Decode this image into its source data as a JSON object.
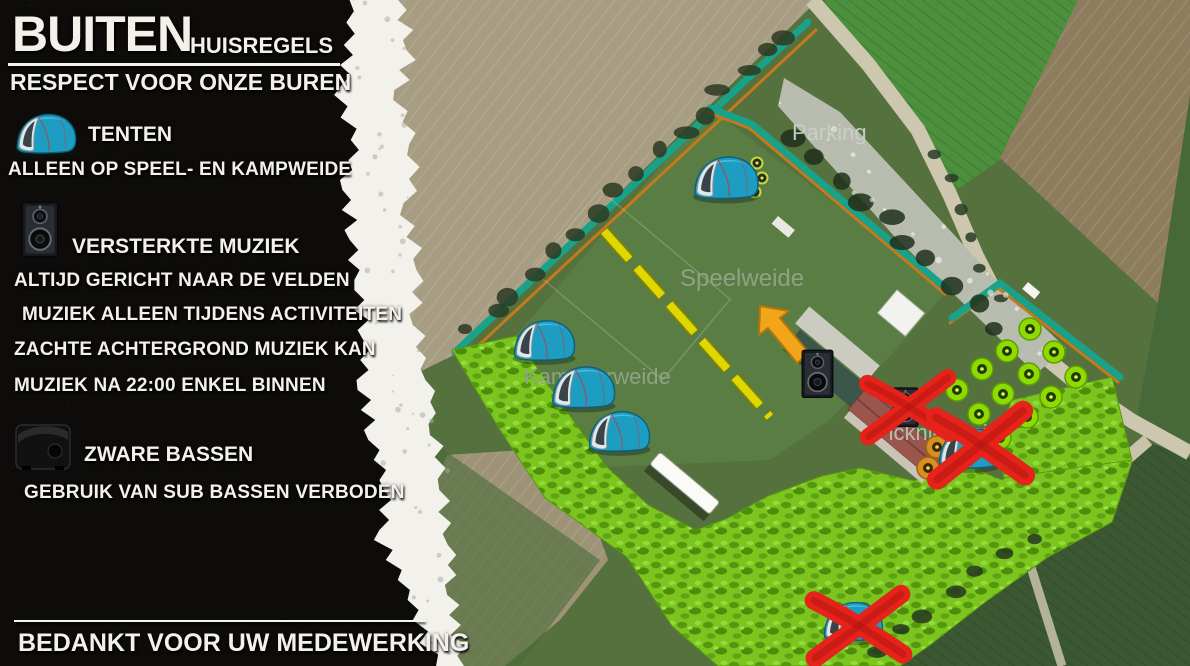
{
  "panel": {
    "title": "BUITEN",
    "subtitle": "HUISREGELS",
    "tagline": "RESPECT VOOR ONZE BUREN",
    "rules": [
      {
        "icon": "tent-icon",
        "heading": "TENTEN",
        "lines": [
          "ALLEEN OP SPEEL- EN KAMPWEIDE"
        ]
      },
      {
        "icon": "speaker-icon",
        "heading": "VERSTERKTE MUZIEK",
        "lines": [
          "ALTIJD GERICHT NAAR DE VELDEN",
          "MUZIEK ALLEEN TIJDENS ACTIVITEITEN",
          "ZACHTE ACHTERGROND MUZIEK KAN",
          "MUZIEK NA 22:00 ENKEL BINNEN"
        ]
      },
      {
        "icon": "subwoofer-icon",
        "heading": "ZWARE BASSEN",
        "lines": [
          "GEBRUIK VAN SUB BASSEN VERBODEN"
        ]
      }
    ],
    "footer": "BEDANKT VOOR UW MEDEWERKING"
  },
  "map": {
    "labels": {
      "parking": "Parking",
      "speelweide": "Speelweide",
      "kampweide": "Kampeerweide",
      "picknickweide": "Picknickweide"
    },
    "legend_icons": [
      "tent-marker",
      "speaker-marker",
      "prohibited-x-mark",
      "tree-marker"
    ],
    "colors": {
      "boundary_teal": "#17a289",
      "boundary_accent": "#c5791c",
      "highlight_green": "#7cc51e",
      "dashed_line_yellow": "#ded800",
      "arrow_orange": "#f2a51a",
      "prohibited_red": "#e5231b"
    }
  }
}
